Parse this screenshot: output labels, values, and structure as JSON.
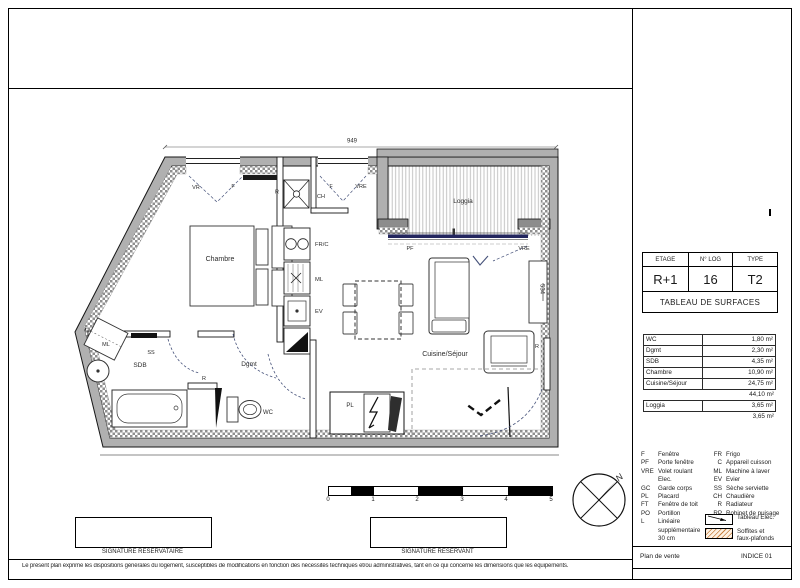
{
  "title_block": {
    "col1_label": "ETAGE",
    "col2_label": "N° LOG",
    "col3_label": "TYPE",
    "col1_value": "R+1",
    "col2_value": "16",
    "col3_value": "T2",
    "surfaces_title": "TABLEAU DE SURFACES"
  },
  "surfaces": {
    "rows": [
      {
        "label": "WC",
        "value": "1,80 m²"
      },
      {
        "label": "Dgmt",
        "value": "2,30 m²"
      },
      {
        "label": "SDB",
        "value": "4,35 m²"
      },
      {
        "label": "Chambre",
        "value": "10,90 m²"
      },
      {
        "label": "Cuisine/Séjour",
        "value": "24,75 m²"
      }
    ],
    "total": "44,10 m²",
    "loggia_label": "Loggia",
    "loggia_value": "3,65 m²",
    "loggia_total": "3,65 m²"
  },
  "legend": {
    "left": [
      {
        "abbr": "F",
        "label": "Fenêtre"
      },
      {
        "abbr": "PF",
        "label": "Porte fenêtre"
      },
      {
        "abbr": "VRE",
        "label": "Volet roulant Elec."
      },
      {
        "abbr": "GC",
        "label": "Garde corps"
      },
      {
        "abbr": "PL",
        "label": "Placard"
      },
      {
        "abbr": "FT",
        "label": "Fenêtre de toit"
      },
      {
        "abbr": "PO",
        "label": "Portillon"
      },
      {
        "abbr": "L",
        "label": "Linéaire supplémentaire 30 cm"
      }
    ],
    "right": [
      {
        "abbr": "FR",
        "label": "Frigo"
      },
      {
        "abbr": "C",
        "label": "Appareil cuisson"
      },
      {
        "abbr": "ML",
        "label": "Machine à laver"
      },
      {
        "abbr": "EV",
        "label": "Evier"
      },
      {
        "abbr": "SS",
        "label": "Sèche serviette"
      },
      {
        "abbr": "CH",
        "label": "Chaudière"
      },
      {
        "abbr": "R",
        "label": "Radiateur"
      },
      {
        "abbr": "RP",
        "label": "Robinet de puisage"
      }
    ],
    "symbol1": "Tableau Elec.",
    "symbol2_line1": "Soffites et",
    "symbol2_line2": "faux-plafonds"
  },
  "footer": {
    "plan_label": "Plan de vente",
    "indice": "INDICE 01",
    "disclaimer": "Le présent plan exprime les dispositions générales du logement, susceptibles de modifications en fonction des nécessités techniques et/ou administratives, tant en ce qui concerne les dimensions que les équipements."
  },
  "signatures": {
    "left": "SIGNATURE RESERVATAIRE",
    "right": "SIGNATURE RESERVANT"
  },
  "scale": {
    "t0": "0",
    "t1": "1",
    "t2": "2",
    "t3": "3",
    "t4": "4",
    "t5": "5"
  },
  "compass": {
    "north": "N"
  },
  "plan": {
    "dim_top": "949",
    "dim_right": "534",
    "rooms": {
      "chambre": "Chambre",
      "loggia": "Loggia",
      "sejour": "Cuisine/Séjour",
      "dgmt": "Dgmt",
      "sdb": "SDB",
      "wc": "WC"
    },
    "labels": {
      "vr": "VR",
      "f1": "F",
      "r_top": "R",
      "ch": "CH",
      "f2": "F",
      "vre_top": "VRE",
      "pf": "PF",
      "vre_loggia": "VRE",
      "frc": "FR/C",
      "ml_cuisine": "ML",
      "ev": "EV",
      "ml_sdb": "ML",
      "ss": "SS",
      "r_hall": "R",
      "r_sejour": "R",
      "pl": "PL"
    }
  }
}
